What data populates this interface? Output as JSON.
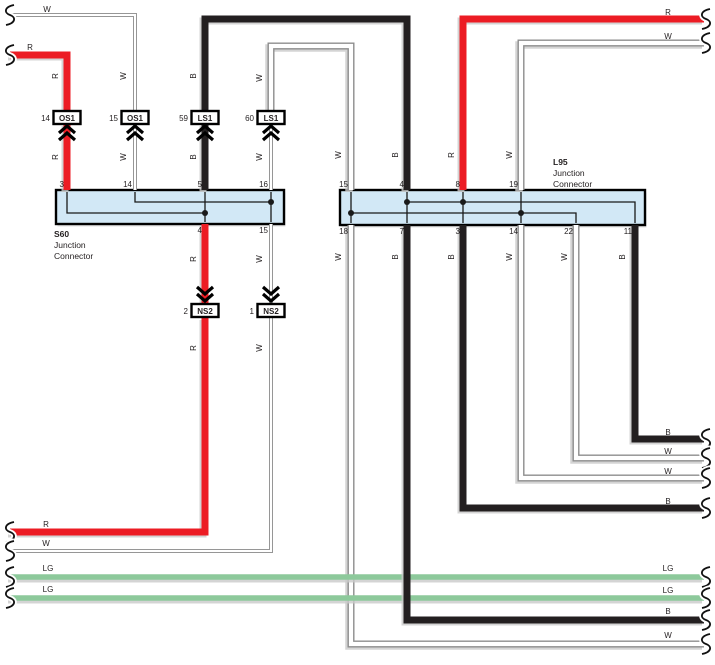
{
  "diagram": {
    "width": 715,
    "height": 665,
    "colors": {
      "red": "#ec1c24",
      "black": "#231f20",
      "wire_outline": "#8d8d8d",
      "wire_outline_thin": "#969696",
      "light_green": "#8dc99b",
      "box_fill": "#d2e8f6",
      "box_border": "#000000",
      "inner_line": "#1a1a1a",
      "shadow": "#c9c9c9",
      "text": "#231f20",
      "white": "#ffffff"
    },
    "junction_connectors": [
      {
        "id": "S60",
        "name_lines": [
          "S60",
          "Junction",
          "Connector"
        ],
        "label_x": 54,
        "label_y": 237,
        "box": [
          56,
          190,
          228,
          34
        ],
        "top_pins": [
          {
            "n": "3",
            "x": 67
          },
          {
            "n": "14",
            "x": 135
          },
          {
            "n": "5",
            "x": 205
          },
          {
            "n": "16",
            "x": 271
          }
        ],
        "bottom_pins": [
          {
            "n": "4",
            "x": 205
          },
          {
            "n": "15",
            "x": 271
          }
        ],
        "internal_lines": [
          [
            [
              67,
              192
            ],
            [
              67,
              213
            ],
            [
              205,
              213
            ]
          ],
          [
            [
              135,
              192
            ],
            [
              135,
              202
            ],
            [
              271,
              202
            ]
          ],
          [
            [
              205,
              192
            ],
            [
              205,
              222
            ]
          ],
          [
            [
              271,
              192
            ],
            [
              271,
              222
            ]
          ]
        ],
        "dots": [
          [
            205,
            213
          ],
          [
            271,
            202
          ]
        ]
      },
      {
        "id": "L95",
        "name_lines": [
          "L95",
          "Junction",
          "Connector"
        ],
        "label_x": 553,
        "label_y": 165,
        "box": [
          340,
          190,
          305,
          35
        ],
        "top_pins": [
          {
            "n": "15",
            "x": 351
          },
          {
            "n": "4",
            "x": 407
          },
          {
            "n": "8",
            "x": 463
          },
          {
            "n": "19",
            "x": 521
          }
        ],
        "bottom_pins": [
          {
            "n": "18",
            "x": 351
          },
          {
            "n": "7",
            "x": 407
          },
          {
            "n": "3",
            "x": 463
          },
          {
            "n": "14",
            "x": 521
          },
          {
            "n": "22",
            "x": 576
          },
          {
            "n": "11",
            "x": 635
          }
        ],
        "internal_lines": [
          [
            [
              351,
              192
            ],
            [
              351,
              223
            ]
          ],
          [
            [
              407,
              192
            ],
            [
              407,
              223
            ]
          ],
          [
            [
              463,
              192
            ],
            [
              463,
              223
            ]
          ],
          [
            [
              521,
              192
            ],
            [
              521,
              223
            ]
          ],
          [
            [
              407,
              202
            ],
            [
              635,
              202
            ],
            [
              635,
              223
            ]
          ],
          [
            [
              351,
              213
            ],
            [
              576,
              213
            ],
            [
              576,
              223
            ]
          ]
        ],
        "dots": [
          [
            407,
            202
          ],
          [
            463,
            202
          ],
          [
            351,
            213
          ],
          [
            521,
            213
          ]
        ]
      }
    ],
    "terminal_connectors": [
      {
        "number": "14",
        "label": "OS1",
        "x": 67,
        "box_y": 111,
        "arrow": "up"
      },
      {
        "number": "15",
        "label": "OS1",
        "x": 135,
        "box_y": 111,
        "arrow": "up"
      },
      {
        "number": "59",
        "label": "LS1",
        "x": 205,
        "box_y": 111,
        "arrow": "up"
      },
      {
        "number": "60",
        "label": "LS1",
        "x": 271,
        "box_y": 111,
        "arrow": "up"
      },
      {
        "number": "2",
        "label": "NS2",
        "x": 205,
        "box_y": 304,
        "arrow": "down"
      },
      {
        "number": "1",
        "label": "NS2",
        "x": 271,
        "box_y": 304,
        "arrow": "down"
      }
    ],
    "wires": [
      {
        "id": "top-left-white",
        "color": "W",
        "weight": "thin",
        "points": [
          [
            10,
            15
          ],
          [
            135,
            15
          ],
          [
            135,
            111
          ]
        ]
      },
      {
        "id": "top-left-red",
        "color": "R",
        "weight": "thick",
        "points": [
          [
            10,
            55
          ],
          [
            67,
            55
          ],
          [
            67,
            111
          ]
        ]
      },
      {
        "id": "os1-14-to-s60",
        "color": "R",
        "weight": "thick",
        "points": [
          [
            67,
            124
          ],
          [
            67,
            190
          ]
        ]
      },
      {
        "id": "os1-15-to-s60",
        "color": "W",
        "weight": "thin",
        "points": [
          [
            135,
            124
          ],
          [
            135,
            190
          ]
        ]
      },
      {
        "id": "ls1-59-loop",
        "color": "B",
        "weight": "thick",
        "points": [
          [
            205,
            111
          ],
          [
            205,
            19
          ],
          [
            407,
            19
          ],
          [
            407,
            190
          ]
        ]
      },
      {
        "id": "ls1-59-to-s60",
        "color": "B",
        "weight": "thick",
        "points": [
          [
            205,
            124
          ],
          [
            205,
            190
          ]
        ]
      },
      {
        "id": "ls1-60-loop",
        "color": "W",
        "weight": "thick",
        "points": [
          [
            271,
            111
          ],
          [
            271,
            46
          ],
          [
            351,
            46
          ],
          [
            351,
            190
          ]
        ]
      },
      {
        "id": "ls1-60-to-s60",
        "color": "W",
        "weight": "thin",
        "points": [
          [
            271,
            124
          ],
          [
            271,
            190
          ]
        ]
      },
      {
        "id": "top-right-red",
        "color": "R",
        "weight": "thick",
        "points": [
          [
            704,
            19
          ],
          [
            463,
            19
          ],
          [
            463,
            190
          ]
        ]
      },
      {
        "id": "top-right-white",
        "color": "W",
        "weight": "thick",
        "points": [
          [
            704,
            43
          ],
          [
            521,
            43
          ],
          [
            521,
            190
          ]
        ]
      },
      {
        "id": "s60-4-to-ns2",
        "color": "R",
        "weight": "thick",
        "points": [
          [
            205,
            224
          ],
          [
            205,
            304
          ]
        ]
      },
      {
        "id": "ns2-2-to-left-edge",
        "color": "R",
        "weight": "thick",
        "points": [
          [
            205,
            318
          ],
          [
            205,
            532
          ],
          [
            10,
            532
          ]
        ]
      },
      {
        "id": "s60-15-to-ns2",
        "color": "W",
        "weight": "thin",
        "points": [
          [
            271,
            224
          ],
          [
            271,
            304
          ]
        ]
      },
      {
        "id": "ns2-1-to-left-edge",
        "color": "W",
        "weight": "thin",
        "points": [
          [
            271,
            318
          ],
          [
            271,
            551
          ],
          [
            10,
            551
          ]
        ]
      },
      {
        "id": "lg-upper",
        "color": "LG",
        "weight": "thick",
        "points": [
          [
            10,
            577
          ],
          [
            704,
            577
          ]
        ]
      },
      {
        "id": "lg-lower",
        "color": "LG",
        "weight": "thick",
        "points": [
          [
            10,
            598
          ],
          [
            704,
            598
          ]
        ]
      },
      {
        "id": "l95-18-white",
        "color": "W",
        "weight": "thick",
        "points": [
          [
            351,
            225
          ],
          [
            351,
            644
          ],
          [
            704,
            644
          ]
        ]
      },
      {
        "id": "l95-7-black",
        "color": "B",
        "weight": "thick",
        "points": [
          [
            407,
            225
          ],
          [
            407,
            620
          ],
          [
            704,
            620
          ]
        ]
      },
      {
        "id": "l95-3-black",
        "color": "B",
        "weight": "thick",
        "points": [
          [
            463,
            225
          ],
          [
            463,
            508
          ],
          [
            704,
            508
          ]
        ]
      },
      {
        "id": "l95-14-white",
        "color": "W",
        "weight": "thick",
        "points": [
          [
            521,
            225
          ],
          [
            521,
            478
          ],
          [
            704,
            478
          ]
        ]
      },
      {
        "id": "l95-22-white",
        "color": "W",
        "weight": "thick",
        "points": [
          [
            576,
            225
          ],
          [
            576,
            458
          ],
          [
            704,
            458
          ]
        ]
      },
      {
        "id": "l95-11-black",
        "color": "B",
        "weight": "thick",
        "points": [
          [
            635,
            225
          ],
          [
            635,
            439
          ],
          [
            704,
            439
          ]
        ]
      }
    ],
    "labels": [
      {
        "text": "W",
        "x": 47,
        "y": 12,
        "rot": 0
      },
      {
        "text": "R",
        "x": 30,
        "y": 50,
        "rot": 0
      },
      {
        "text": "R",
        "x": 668,
        "y": 15,
        "rot": 0
      },
      {
        "text": "W",
        "x": 668,
        "y": 39,
        "rot": 0
      },
      {
        "text": "R",
        "x": 58,
        "y": 76,
        "rot": 1
      },
      {
        "text": "W",
        "x": 126,
        "y": 76,
        "rot": 1
      },
      {
        "text": "B",
        "x": 196,
        "y": 76,
        "rot": 1
      },
      {
        "text": "W",
        "x": 262,
        "y": 78,
        "rot": 1
      },
      {
        "text": "R",
        "x": 58,
        "y": 157,
        "rot": 1
      },
      {
        "text": "W",
        "x": 126,
        "y": 157,
        "rot": 1
      },
      {
        "text": "B",
        "x": 196,
        "y": 157,
        "rot": 1
      },
      {
        "text": "W",
        "x": 262,
        "y": 157,
        "rot": 1
      },
      {
        "text": "W",
        "x": 341,
        "y": 155,
        "rot": 1
      },
      {
        "text": "B",
        "x": 398,
        "y": 155,
        "rot": 1
      },
      {
        "text": "R",
        "x": 454,
        "y": 155,
        "rot": 1
      },
      {
        "text": "W",
        "x": 512,
        "y": 155,
        "rot": 1
      },
      {
        "text": "R",
        "x": 196,
        "y": 259,
        "rot": 1
      },
      {
        "text": "W",
        "x": 262,
        "y": 259,
        "rot": 1
      },
      {
        "text": "W",
        "x": 341,
        "y": 257,
        "rot": 1
      },
      {
        "text": "B",
        "x": 398,
        "y": 257,
        "rot": 1
      },
      {
        "text": "B",
        "x": 454,
        "y": 257,
        "rot": 1
      },
      {
        "text": "W",
        "x": 512,
        "y": 257,
        "rot": 1
      },
      {
        "text": "W",
        "x": 567,
        "y": 257,
        "rot": 1
      },
      {
        "text": "B",
        "x": 625,
        "y": 257,
        "rot": 1
      },
      {
        "text": "R",
        "x": 196,
        "y": 348,
        "rot": 1
      },
      {
        "text": "W",
        "x": 262,
        "y": 348,
        "rot": 1
      },
      {
        "text": "B",
        "x": 668,
        "y": 435,
        "rot": 0
      },
      {
        "text": "W",
        "x": 668,
        "y": 454,
        "rot": 0
      },
      {
        "text": "W",
        "x": 668,
        "y": 474,
        "rot": 0
      },
      {
        "text": "B",
        "x": 668,
        "y": 504,
        "rot": 0
      },
      {
        "text": "R",
        "x": 46,
        "y": 527,
        "rot": 0
      },
      {
        "text": "W",
        "x": 46,
        "y": 546,
        "rot": 0
      },
      {
        "text": "LG",
        "x": 48,
        "y": 571,
        "rot": 0
      },
      {
        "text": "LG",
        "x": 48,
        "y": 592,
        "rot": 0
      },
      {
        "text": "LG",
        "x": 668,
        "y": 571,
        "rot": 0
      },
      {
        "text": "LG",
        "x": 668,
        "y": 593,
        "rot": 0
      },
      {
        "text": "B",
        "x": 668,
        "y": 614,
        "rot": 0
      },
      {
        "text": "W",
        "x": 668,
        "y": 638,
        "rot": 0
      }
    ],
    "breaks": [
      {
        "x": 9,
        "y": 15
      },
      {
        "x": 9,
        "y": 55
      },
      {
        "x": 9,
        "y": 532
      },
      {
        "x": 9,
        "y": 551
      },
      {
        "x": 9,
        "y": 577
      },
      {
        "x": 9,
        "y": 598
      },
      {
        "x": 705,
        "y": 19
      },
      {
        "x": 705,
        "y": 43
      },
      {
        "x": 705,
        "y": 439
      },
      {
        "x": 705,
        "y": 458
      },
      {
        "x": 705,
        "y": 478
      },
      {
        "x": 705,
        "y": 508
      },
      {
        "x": 705,
        "y": 577
      },
      {
        "x": 705,
        "y": 598
      },
      {
        "x": 705,
        "y": 620
      },
      {
        "x": 705,
        "y": 644
      }
    ]
  }
}
